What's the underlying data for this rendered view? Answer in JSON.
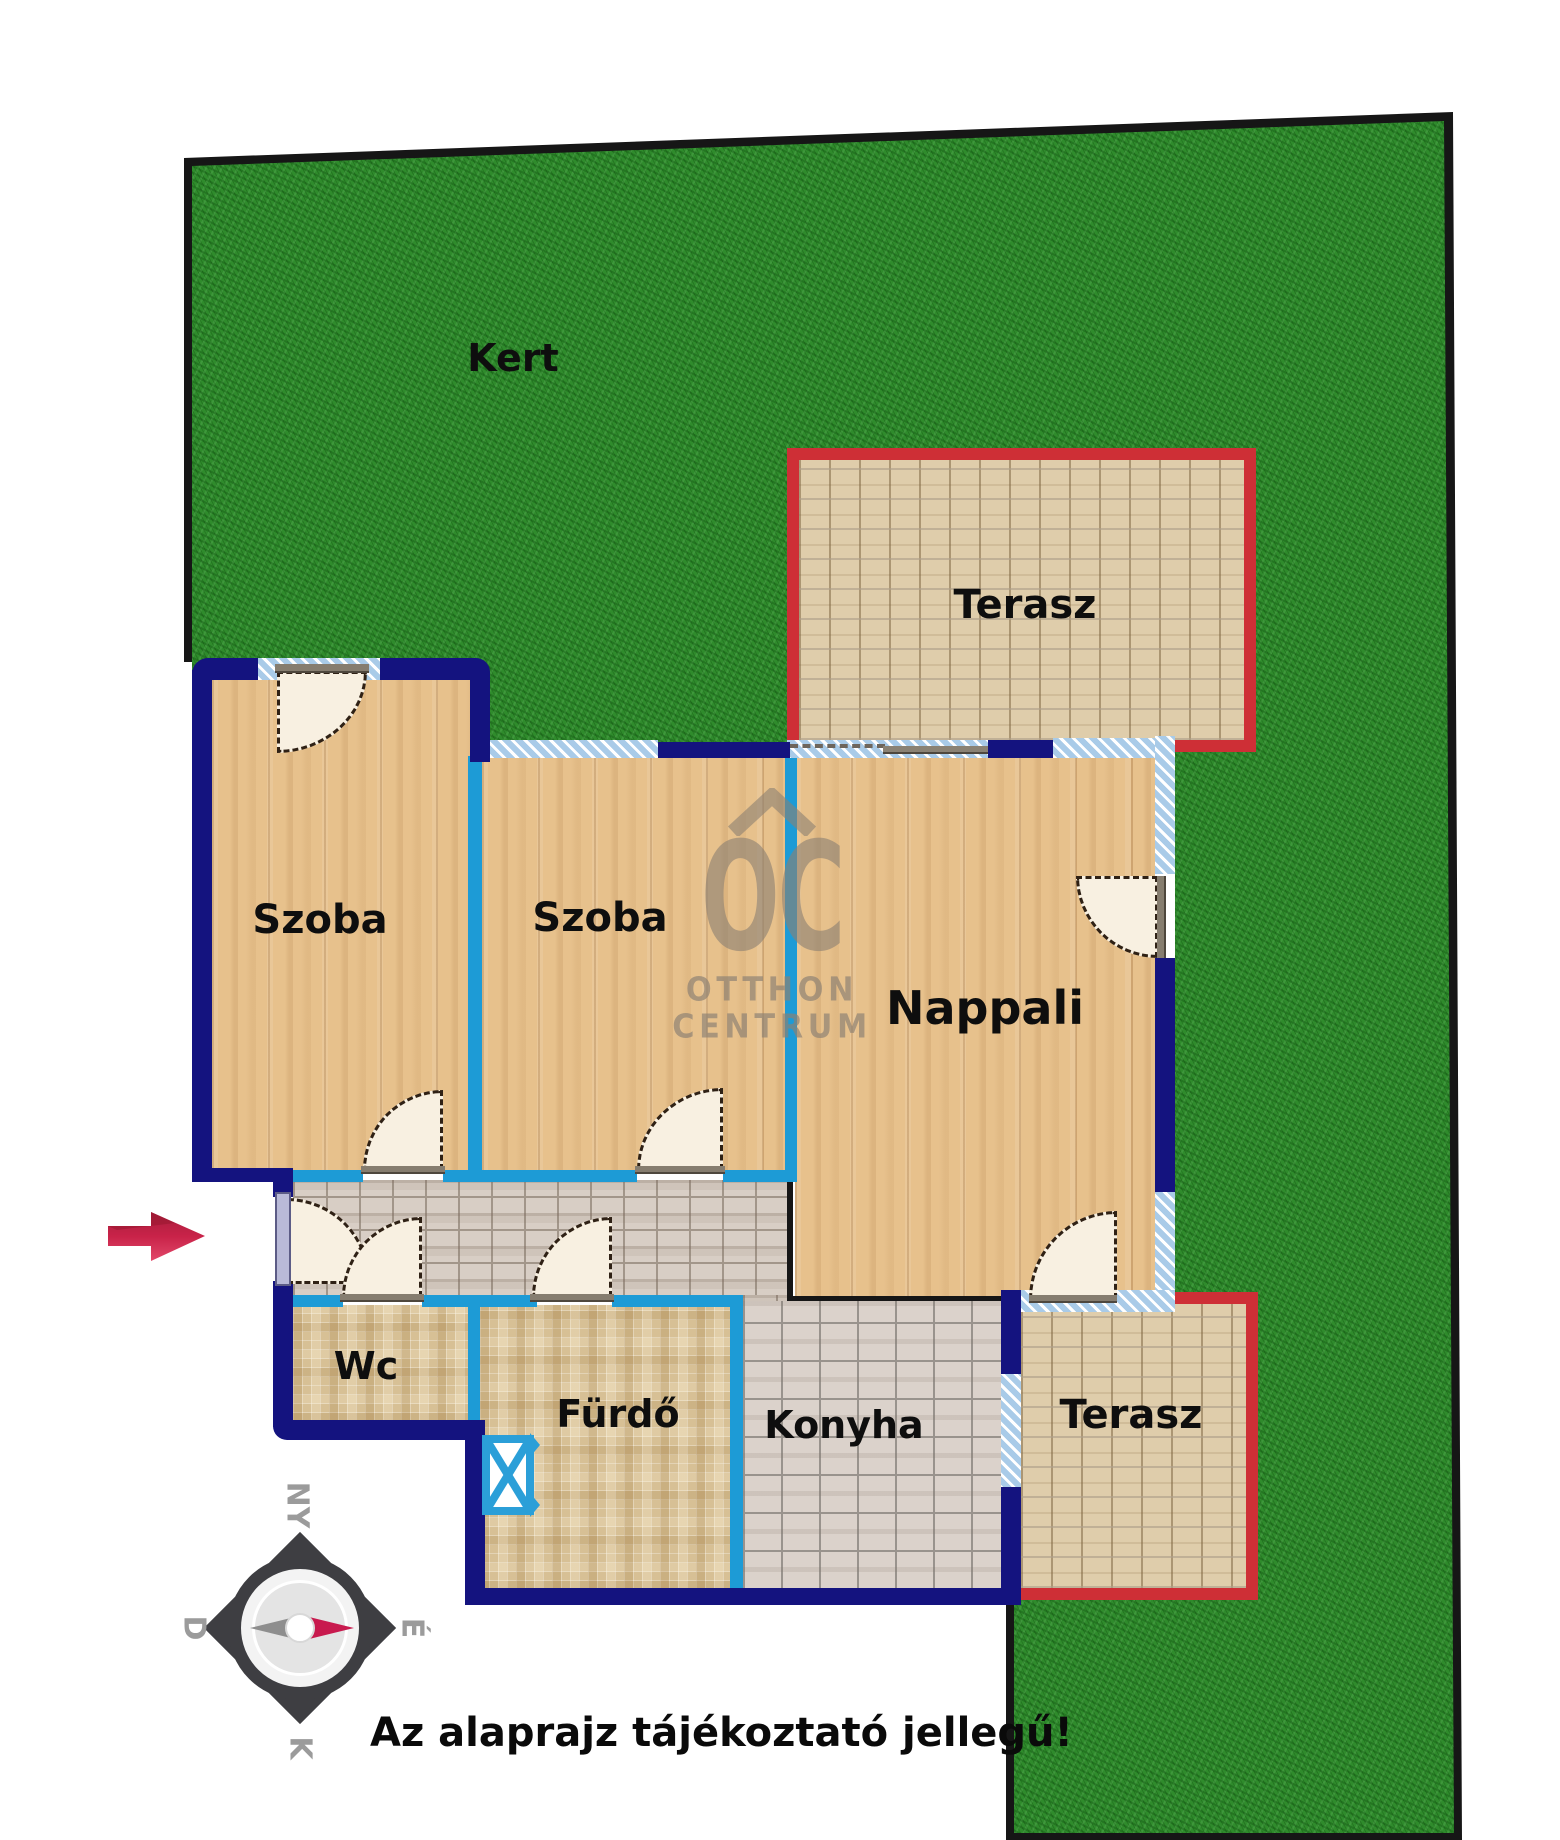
{
  "labels": {
    "garden": "Kert",
    "terrace_top": "Terasz",
    "terrace_bottom": "Terasz",
    "room_left": "Szoba",
    "room_middle": "Szoba",
    "living_room": "Nappali",
    "wc": "Wc",
    "bathroom": "Fürdő",
    "kitchen": "Konyha"
  },
  "disclaimer": "Az alaprajz tájékoztató jellegű!",
  "compass": {
    "top": "NY",
    "left": "D",
    "right": "É",
    "bottom": "K"
  },
  "watermark": {
    "logo": "OC",
    "line1": "OTTHON",
    "line2": "CENTRUM"
  },
  "colors": {
    "outer_wall": "#14137f",
    "partition_wall": "#1d9bd6",
    "window": "#a9cbe8",
    "terrace_border": "#ce2f36",
    "grass": "#2f8b2c",
    "plot_border": "#161616",
    "entrance_arrow": "#c9234a"
  }
}
